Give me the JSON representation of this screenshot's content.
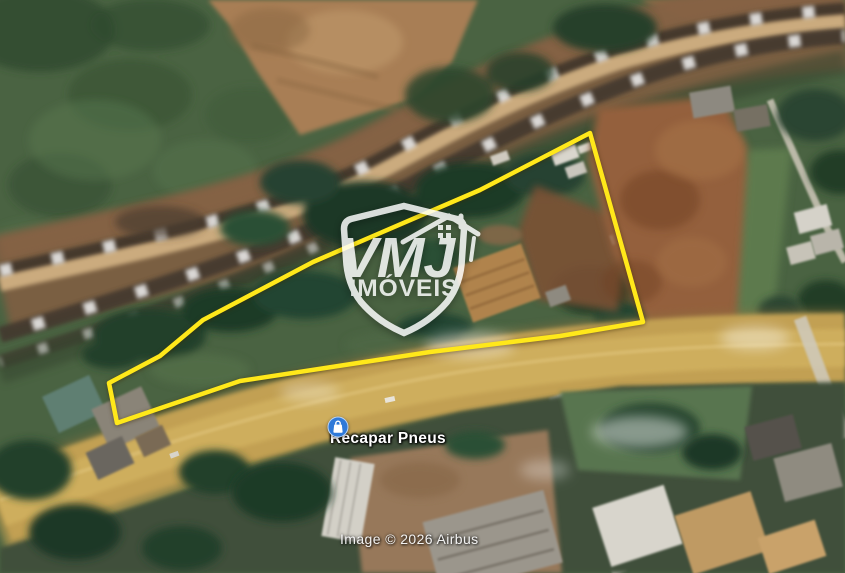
{
  "watermark": {
    "brand": "VMJ",
    "subtitle": "IMÓVEIS"
  },
  "place": {
    "name": "Recapar Pneus"
  },
  "attribution": {
    "text": "Image © 2026 Airbus"
  },
  "parcel": {
    "points": "590,133 480,190 313,262 203,320 160,356 109,383 117,423 240,381 430,352 560,336 643,322",
    "color": "#ffe81a"
  },
  "pin": {
    "color": "#2e79d8"
  }
}
